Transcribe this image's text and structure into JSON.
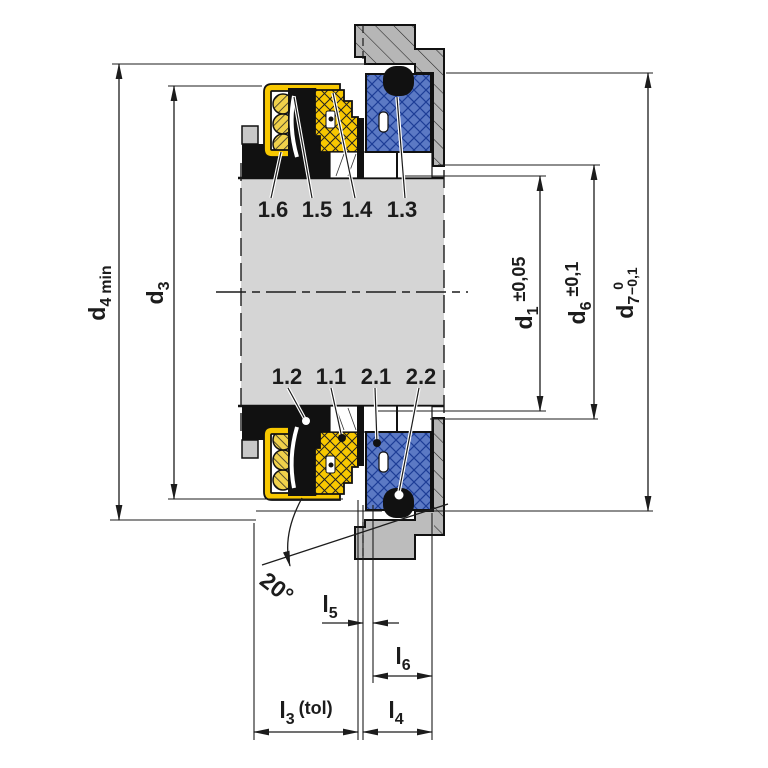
{
  "part_labels": {
    "top": [
      "1.6",
      "1.5",
      "1.4",
      "1.3"
    ],
    "bottom": [
      "1.2",
      "1.1",
      "2.1",
      "2.2"
    ]
  },
  "dimensions": {
    "d4": {
      "base": "d",
      "sub": "4",
      "suffix": "min"
    },
    "d3": {
      "base": "d",
      "sub": "3"
    },
    "d1": {
      "base": "d",
      "sub": "1",
      "tolerance": "±0,05"
    },
    "d6": {
      "base": "d",
      "sub": "6",
      "tolerance": "±0,1"
    },
    "d7": {
      "base": "d",
      "sub": "7",
      "tolerance_upper": "0",
      "tolerance_lower": "−0,1"
    },
    "l5": {
      "base": "l",
      "sub": "5"
    },
    "l6": {
      "base": "l",
      "sub": "6"
    },
    "l3": {
      "base": "l",
      "sub": "3",
      "suffix": "(tol)"
    },
    "l4": {
      "base": "l",
      "sub": "4"
    },
    "angle": "20°"
  },
  "colors": {
    "component_yellow": "#f8c800",
    "component_blue": "#5b79c4",
    "housing_gray": "#b6b6b6",
    "shaft_gray": "#d5d5d5",
    "line_black": "#1c1c1c",
    "background": "#ffffff"
  }
}
